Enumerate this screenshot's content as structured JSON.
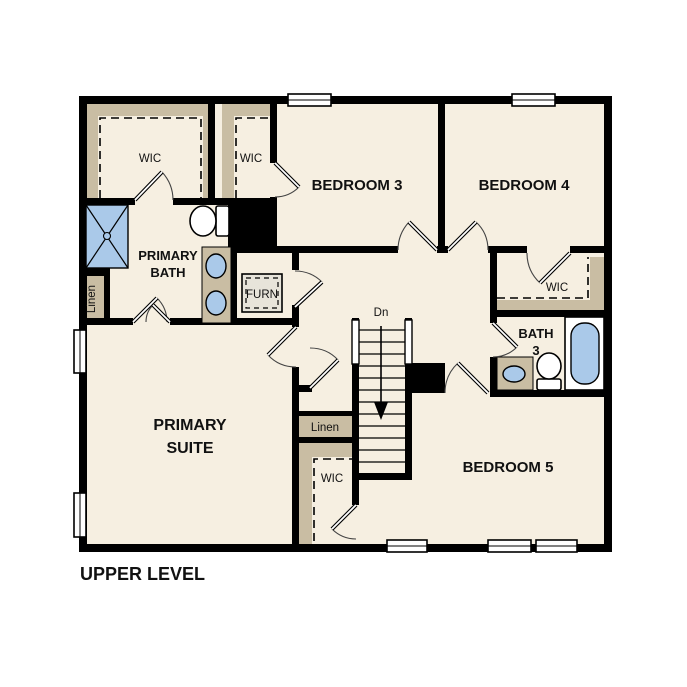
{
  "title": "UPPER LEVEL",
  "colors": {
    "background": "#ffffff",
    "wall": "#000000",
    "room_fill": "#f6efe1",
    "closet_tan": "#c9bda3",
    "fixture_blue": "#aac9e9"
  },
  "rooms": {
    "primary_suite": {
      "line1": "PRIMARY",
      "line2": "SUITE"
    },
    "primary_bath": {
      "line1": "PRIMARY",
      "line2": "BATH"
    },
    "bedroom3": "BEDROOM 3",
    "bedroom4": "BEDROOM 4",
    "bedroom5": "BEDROOM 5",
    "bath3": {
      "line1": "BATH",
      "line2": "3"
    },
    "wic_primary": "WIC",
    "wic_hall": "WIC",
    "wic_bedroom4": "WIC",
    "wic_bedroom5": "WIC",
    "linen_upper": "Linen",
    "linen_lower": "Linen",
    "furnace": "FURN"
  },
  "stairs": {
    "direction_label": "Dn"
  }
}
